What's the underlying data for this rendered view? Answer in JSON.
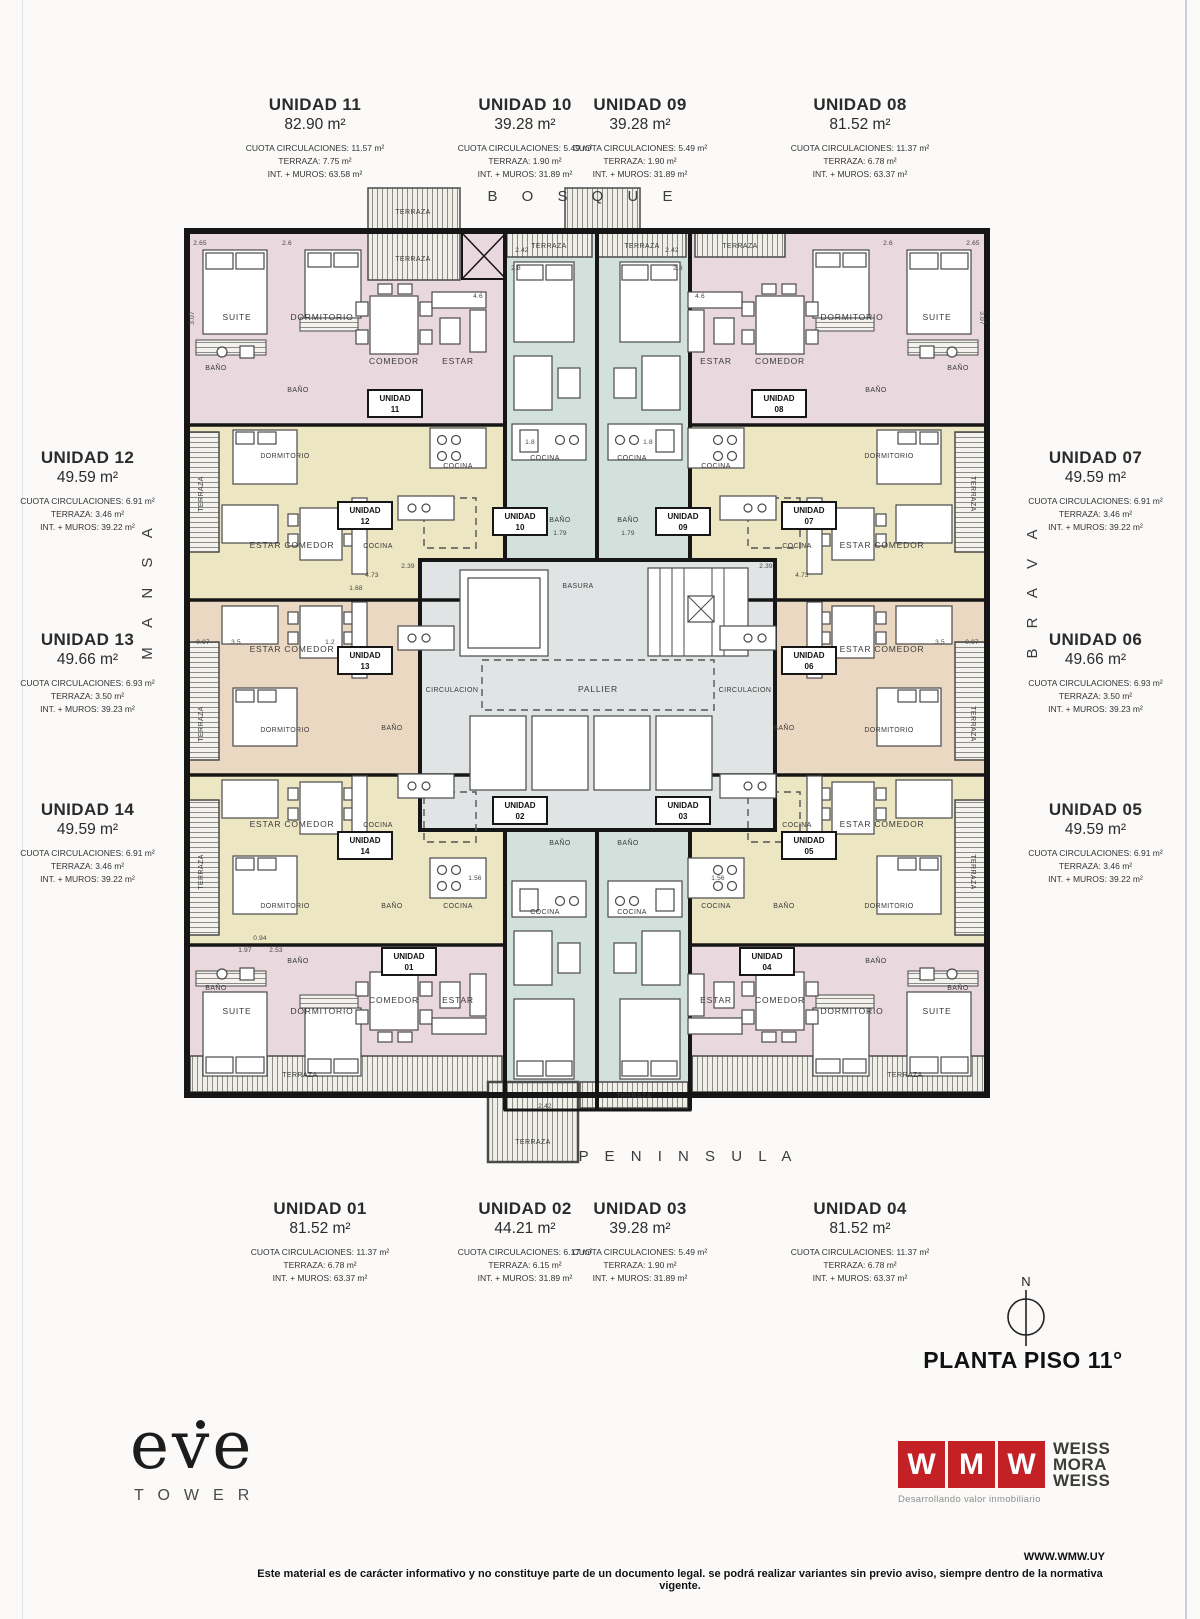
{
  "page": {
    "orientation": {
      "top": "B O S Q U E",
      "bottom": "P E N I N S U L A",
      "left": "M A N S A",
      "right": "B R A V A"
    },
    "floor_title": "PLANTA PISO 11°",
    "compass_n": "N",
    "website": "WWW.WMW.UY",
    "disclaimer": "Este material es de carácter informativo y no constituye parte de un documento legal. se podrá realizar variantes sin previo aviso, siempre dentro de la normativa vigente."
  },
  "brand": {
    "name": "eve",
    "sub": "TOWER"
  },
  "developer": {
    "letters": [
      "W",
      "M",
      "W"
    ],
    "names": [
      "WEISS",
      "MORA",
      "WEISS"
    ],
    "tagline": "Desarrollando valor inmobiliario",
    "red": "#c42127"
  },
  "colors": {
    "pink": "#e9d8de",
    "yellow": "#ece6c3",
    "tan": "#ebd8c2",
    "teal": "#d3e1dc",
    "core": "#e1e4e5",
    "wall": "#161616"
  },
  "units": {
    "u01": {
      "name": "UNIDAD 01",
      "area": "81.52 m²",
      "cuota": "CUOTA CIRCULACIONES: 11.37 m²",
      "terraza": "TERRAZA: 6.78 m²",
      "int_muros": "INT. + MUROS: 63.37 m²"
    },
    "u02": {
      "name": "UNIDAD 02",
      "area": "44.21 m²",
      "cuota": "CUOTA CIRCULACIONES: 6.17 m²",
      "terraza": "TERRAZA: 6.15 m²",
      "int_muros": "INT. + MUROS: 31.89 m²"
    },
    "u03": {
      "name": "UNIDAD 03",
      "area": "39.28 m²",
      "cuota": "CUOTA CIRCULACIONES: 5.49 m²",
      "terraza": "TERRAZA: 1.90 m²",
      "int_muros": "INT. + MUROS: 31.89 m²"
    },
    "u04": {
      "name": "UNIDAD 04",
      "area": "81.52 m²",
      "cuota": "CUOTA CIRCULACIONES: 11.37 m²",
      "terraza": "TERRAZA: 6.78 m²",
      "int_muros": "INT. + MUROS: 63.37 m²"
    },
    "u05": {
      "name": "UNIDAD 05",
      "area": "49.59 m²",
      "cuota": "CUOTA CIRCULACIONES: 6.91 m²",
      "terraza": "TERRAZA: 3.46 m²",
      "int_muros": "INT. + MUROS: 39.22 m²"
    },
    "u06": {
      "name": "UNIDAD 06",
      "area": "49.66 m²",
      "cuota": "CUOTA CIRCULACIONES: 6.93 m²",
      "terraza": "TERRAZA: 3.50 m²",
      "int_muros": "INT. + MUROS: 39.23 m²"
    },
    "u07": {
      "name": "UNIDAD 07",
      "area": "49.59 m²",
      "cuota": "CUOTA CIRCULACIONES: 6.91 m²",
      "terraza": "TERRAZA: 3.46 m²",
      "int_muros": "INT. + MUROS: 39.22 m²"
    },
    "u08": {
      "name": "UNIDAD 08",
      "area": "81.52 m²",
      "cuota": "CUOTA CIRCULACIONES: 11.37 m²",
      "terraza": "TERRAZA: 6.78 m²",
      "int_muros": "INT. + MUROS: 63.37 m²"
    },
    "u09": {
      "name": "UNIDAD 09",
      "area": "39.28 m²",
      "cuota": "CUOTA CIRCULACIONES: 5.49 m²",
      "terraza": "TERRAZA: 1.90 m²",
      "int_muros": "INT. + MUROS: 31.89 m²"
    },
    "u10": {
      "name": "UNIDAD 10",
      "area": "39.28 m²",
      "cuota": "CUOTA CIRCULACIONES: 5.49 m²",
      "terraza": "TERRAZA: 1.90 m²",
      "int_muros": "INT. + MUROS: 31.89 m²"
    },
    "u11": {
      "name": "UNIDAD 11",
      "area": "82.90 m²",
      "cuota": "CUOTA CIRCULACIONES: 11.57 m²",
      "terraza": "TERRAZA: 7.75 m²",
      "int_muros": "INT. + MUROS: 63.58 m²"
    },
    "u12": {
      "name": "UNIDAD 12",
      "area": "49.59 m²",
      "cuota": "CUOTA CIRCULACIONES: 6.91 m²",
      "terraza": "TERRAZA: 3.46 m²",
      "int_muros": "INT. + MUROS: 39.22 m²"
    },
    "u13": {
      "name": "UNIDAD 13",
      "area": "49.66 m²",
      "cuota": "CUOTA CIRCULACIONES: 6.93 m²",
      "terraza": "TERRAZA: 3.50 m²",
      "int_muros": "INT. + MUROS: 39.23 m²"
    },
    "u14": {
      "name": "UNIDAD 14",
      "area": "49.59 m²",
      "cuota": "CUOTA CIRCULACIONES: 6.91 m²",
      "terraza": "TERRAZA: 3.46 m²",
      "int_muros": "INT. + MUROS: 39.22 m²"
    }
  },
  "plan": {
    "unit_word": "UNIDAD",
    "numbers": {
      "n01": "01",
      "n02": "02",
      "n03": "03",
      "n04": "04",
      "n05": "05",
      "n06": "06",
      "n07": "07",
      "n08": "08",
      "n09": "09",
      "n10": "10",
      "n11": "11",
      "n12": "12",
      "n13": "13",
      "n14": "14"
    },
    "rooms": {
      "suite": "SUITE",
      "dormitorio": "DORMITORIO",
      "comedor": "COMEDOR",
      "estar": "ESTAR",
      "estar_comedor": "ESTAR COMEDOR",
      "cocina": "COCINA",
      "bano": "BAÑO",
      "terraza": "TERRAZA",
      "circulacion": "CIRCULACION",
      "pallier": "PALLIER",
      "basura": "BASURA"
    },
    "dims": {
      "v265": "2.65",
      "v26": "2.6",
      "v28": "2.8",
      "v46": "4.6",
      "v473": "4.73",
      "v239": "2.39",
      "v18": "1.8",
      "v179": "1.79",
      "v35": "3.5",
      "v097": "0.97",
      "v197": "1.97",
      "v253": "2.53",
      "v094": "0.94",
      "v242": "2.42",
      "v307": "3.07",
      "v156": "1.56",
      "v168": "1.68",
      "v12": "1.2"
    }
  }
}
